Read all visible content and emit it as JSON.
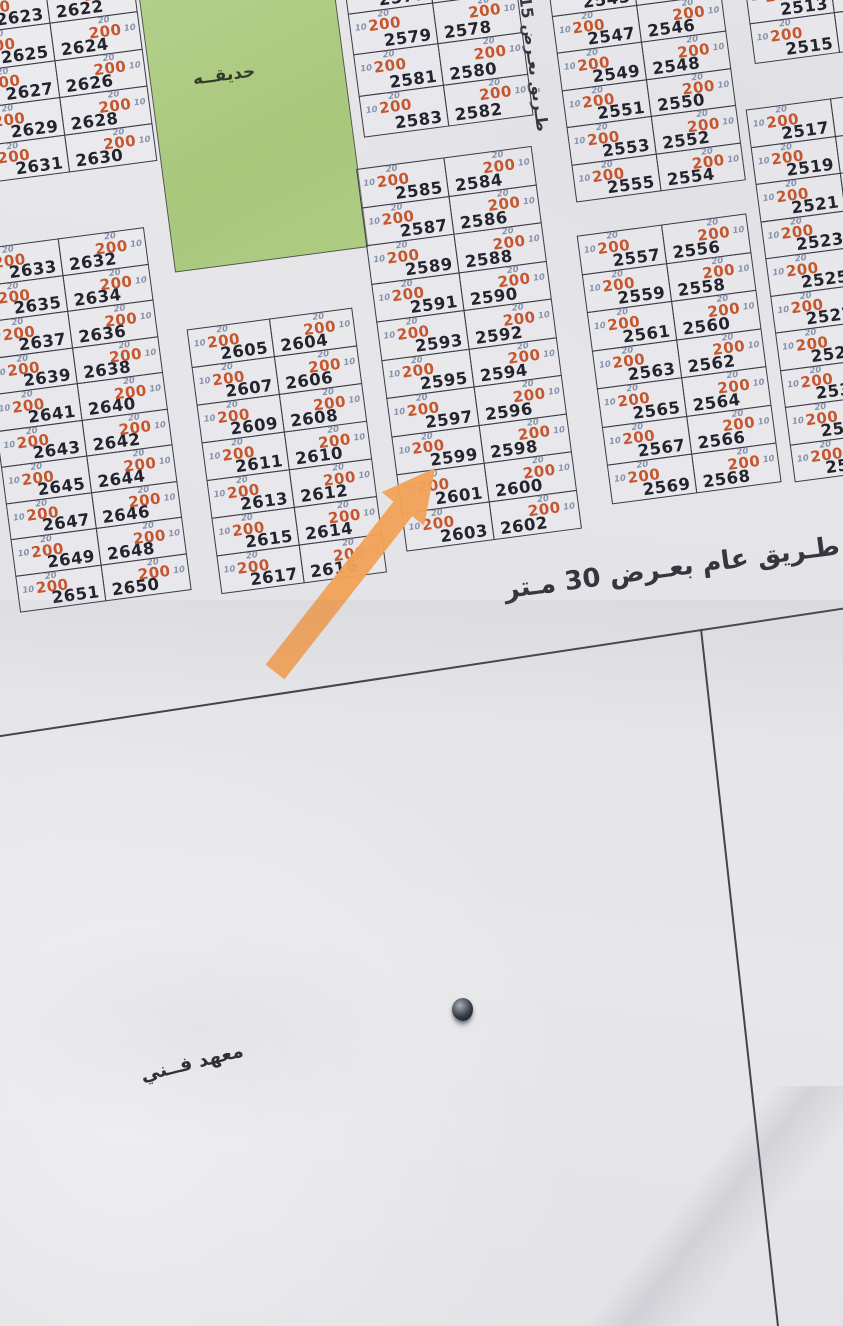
{
  "map": {
    "area_label": "200",
    "depth_label": "20",
    "width_label": "10",
    "park_label": "حديقــه",
    "road15_label": "طـريق بعـرض 15",
    "road30_label": "طـريق عام بعـرض 30 مـتر",
    "institute_label": "معهد فــني",
    "highlight": {
      "arrow_points_to": "2599"
    },
    "colors": {
      "paper": "#e7e7ea",
      "line": "#3a3b44",
      "plot_number": "#23242e",
      "area_value": "#c5562d",
      "dimension_value": "#8792ab",
      "park_green": "#aecb80",
      "arrow_orange": "#f1a258"
    },
    "blocks": [
      {
        "id": "A",
        "rows": [
          [
            "2621",
            "2620"
          ],
          [
            "2623",
            "2622"
          ],
          [
            "2625",
            "2624"
          ],
          [
            "2627",
            "2626"
          ],
          [
            "2629",
            "2628"
          ],
          [
            "2631",
            "2630"
          ]
        ]
      },
      {
        "id": "B",
        "rows": [
          [
            "2633",
            "2632"
          ],
          [
            "2635",
            "2634"
          ],
          [
            "2637",
            "2636"
          ],
          [
            "2639",
            "2638"
          ],
          [
            "2641",
            "2640"
          ],
          [
            "2643",
            "2642"
          ],
          [
            "2645",
            "2644"
          ],
          [
            "2647",
            "2646"
          ],
          [
            "2649",
            "2648"
          ],
          [
            "2651",
            "2650"
          ]
        ]
      },
      {
        "id": "C",
        "rows": [
          [
            "2605",
            "2604"
          ],
          [
            "2607",
            "2606"
          ],
          [
            "2609",
            "2608"
          ],
          [
            "2611",
            "2610"
          ],
          [
            "2613",
            "2612"
          ],
          [
            "2615",
            "2614"
          ],
          [
            "2617",
            "2616"
          ]
        ]
      },
      {
        "id": "D",
        "rows": [
          [
            "2577",
            "2576"
          ],
          [
            "2579",
            "2578"
          ],
          [
            "2581",
            "2580"
          ],
          [
            "2583",
            "2582"
          ]
        ]
      },
      {
        "id": "E",
        "rows": [
          [
            "2585",
            "2584"
          ],
          [
            "2587",
            "2586"
          ],
          [
            "2589",
            "2588"
          ],
          [
            "2591",
            "2590"
          ],
          [
            "2593",
            "2592"
          ],
          [
            "2595",
            "2594"
          ],
          [
            "2597",
            "2596"
          ],
          [
            "2599",
            "2598"
          ],
          [
            "2601",
            "2600"
          ],
          [
            "2603",
            "2602"
          ]
        ]
      },
      {
        "id": "F",
        "rows": [
          [
            "2545",
            "2544"
          ],
          [
            "2547",
            "2546"
          ],
          [
            "2549",
            "2548"
          ],
          [
            "2551",
            "2550"
          ],
          [
            "2553",
            "2552"
          ],
          [
            "2555",
            "2554"
          ]
        ]
      },
      {
        "id": "G",
        "rows": [
          [
            "2557",
            "2556"
          ],
          [
            "2559",
            "2558"
          ],
          [
            "2561",
            "2560"
          ],
          [
            "2563",
            "2562"
          ],
          [
            "2565",
            "2564"
          ],
          [
            "2567",
            "2566"
          ],
          [
            "2569",
            "2568"
          ]
        ]
      },
      {
        "id": "H1",
        "rows": [
          [
            "2513",
            null
          ],
          [
            "2515",
            null
          ]
        ]
      },
      {
        "id": "H2",
        "rows": [
          [
            "2517",
            null
          ],
          [
            "2519",
            null
          ],
          [
            "2521",
            null
          ],
          [
            "2523",
            null
          ],
          [
            "2525",
            null
          ],
          [
            "2527",
            null
          ],
          [
            "2529",
            null
          ],
          [
            "2531",
            null
          ],
          [
            "2533",
            null
          ],
          [
            "2535",
            null
          ]
        ]
      }
    ]
  }
}
